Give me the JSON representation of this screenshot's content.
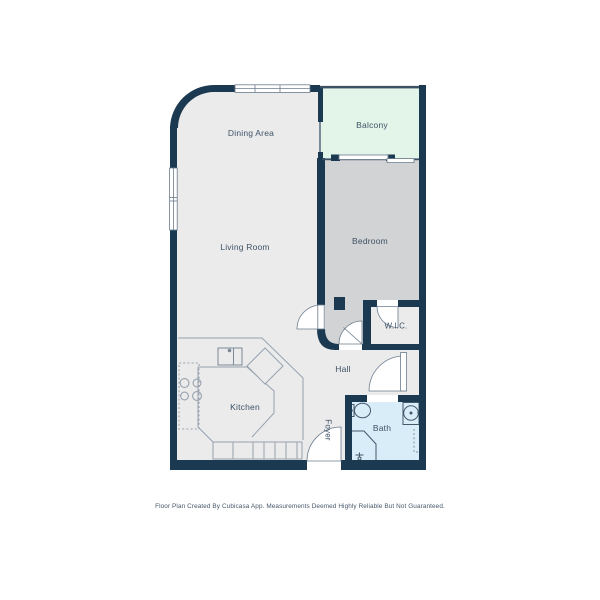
{
  "floor_plan": {
    "title": "Apartment floor plan",
    "rooms": [
      {
        "id": "dining-area",
        "label": "Dining Area"
      },
      {
        "id": "balcony",
        "label": "Balcony"
      },
      {
        "id": "living-room",
        "label": "Living Room"
      },
      {
        "id": "bedroom",
        "label": "Bedroom"
      },
      {
        "id": "wic",
        "label": "W.I.C."
      },
      {
        "id": "hall",
        "label": "Hall"
      },
      {
        "id": "kitchen",
        "label": "Kitchen"
      },
      {
        "id": "foyer",
        "label": "Foyer"
      },
      {
        "id": "bath",
        "label": "Bath"
      }
    ],
    "fixture_icons": [
      "stove-icon",
      "kitchen-sink-icon",
      "kitchen-island",
      "cabinet-run",
      "toilet-icon",
      "bathroom-sink-icon",
      "shower-icon",
      "sliding-door-icon",
      "entry-door-icon",
      "window"
    ],
    "colors": {
      "wall": "#1b3951",
      "floor_main": "#ebebec",
      "floor_bedroom": "#d2d3d4",
      "floor_balcony": "#e3f4e9",
      "floor_bath": "#d8edf8",
      "thin_line": "#97a2ae",
      "fixture_line": "#44586c",
      "label_text": "#3e5266"
    },
    "footer": "Floor Plan Created By Cubicasa App. Measurements Deemed Highly Reliable But Not Guaranteed."
  }
}
